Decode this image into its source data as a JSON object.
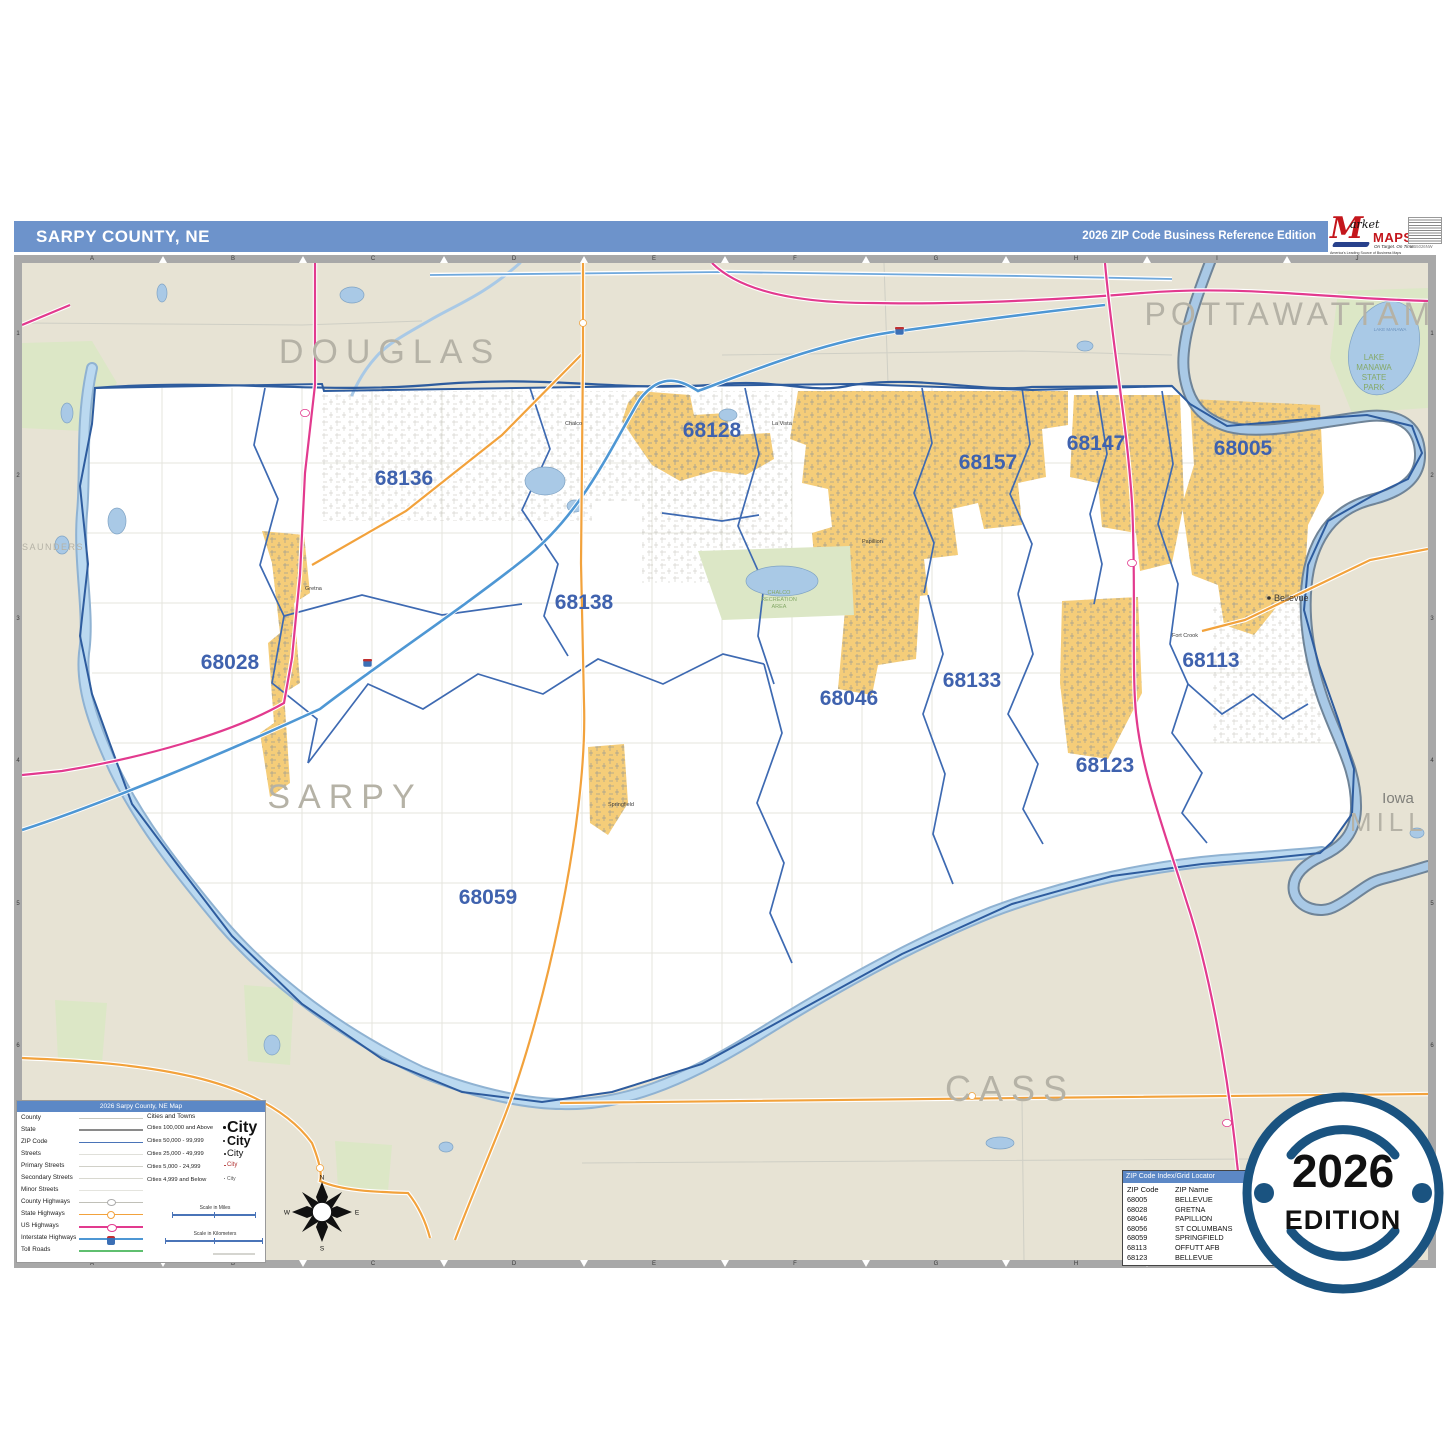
{
  "header": {
    "title": "SARPY COUNTY, NE",
    "edition": "2026 ZIP Code Business Reference Edition"
  },
  "logo": {
    "market": "Market",
    "maps": "MAPS",
    "tagline": "On Target. On Time.",
    "subtagline": "America's Leading Source of Business Maps",
    "code": "W55026NW"
  },
  "map": {
    "county_labels": {
      "douglas": "DOUGLAS",
      "pottawattamie": "POTTAWATTAMIE",
      "sarpy": "SARPY",
      "cass": "CASS",
      "mills": "MILLS",
      "saunders": "SAUNDERS"
    },
    "state_label": "Iowa",
    "zips": [
      "68136",
      "68128",
      "68157",
      "68147",
      "68005",
      "68138",
      "68028",
      "68046",
      "68133",
      "68113",
      "68123",
      "68059"
    ],
    "cities": {
      "bellevue": "Bellevue",
      "chalco": "Chalco",
      "la_vista": "La Vista",
      "papillion": "Papillion",
      "gretna": "Gretna",
      "springfield": "Springfield",
      "fort_crook": "Fort Crook"
    },
    "parks": {
      "chalco_l1": "CHALCO",
      "chalco_l2": "RECREATION",
      "chalco_l3": "AREA",
      "manawa_l1": "LAKE",
      "manawa_l2": "MANAWA",
      "manawa_l3": "STATE",
      "manawa_l4": "PARK",
      "manawa_lake": "LAKE MANAWA"
    }
  },
  "grid": {
    "cols": [
      "A",
      "B",
      "C",
      "D",
      "E",
      "F",
      "G",
      "H",
      "I",
      "J"
    ],
    "rows": [
      "1",
      "2",
      "3",
      "4",
      "5",
      "6",
      "7"
    ]
  },
  "legend": {
    "title": "2026 Sarpy County, NE Map",
    "line_items": [
      "County",
      "State",
      "ZIP Code",
      "Streets",
      "Primary Streets",
      "Secondary Streets",
      "Minor Streets",
      "County Highways",
      "State Highways",
      "US Highways",
      "Interstate Highways",
      "Toll Roads"
    ],
    "cities_header": "Cities and Towns",
    "city_rows": [
      {
        "label": "Cities 100,000 and Above",
        "sample": "City"
      },
      {
        "label": "Cities 50,000 - 99,999",
        "sample": "City"
      },
      {
        "label": "Cities 25,000 - 49,999",
        "sample": "City"
      },
      {
        "label": "Cities 5,000 - 24,999",
        "sample": "City"
      },
      {
        "label": "Cities 4,999 and Below",
        "sample": "City"
      }
    ],
    "scale_miles": "Scale in Miles",
    "scale_km": "Scale in Kilometers"
  },
  "zip_index": {
    "title": "ZIP Code Index/Grid Locator",
    "col_code": "ZIP Code",
    "col_name": "ZIP Name",
    "rows": [
      {
        "code": "68005",
        "name": "BELLEVUE",
        "grid": ""
      },
      {
        "code": "68028",
        "name": "GRETNA",
        "grid": ""
      },
      {
        "code": "68046",
        "name": "PAPILLION",
        "grid": ""
      },
      {
        "code": "68056",
        "name": "ST COLUMBANS",
        "grid": "I3"
      },
      {
        "code": "68059",
        "name": "SPRINGFIELD",
        "grid": "D5"
      },
      {
        "code": "68113",
        "name": "OFFUTT AFB",
        "grid": "I3"
      },
      {
        "code": "68123",
        "name": "BELLEVUE",
        "grid": "I3"
      }
    ]
  },
  "badge": {
    "year": "2026",
    "word": "EDITION"
  },
  "compass": {
    "n": "N",
    "e": "E",
    "s": "S",
    "w": "W"
  }
}
